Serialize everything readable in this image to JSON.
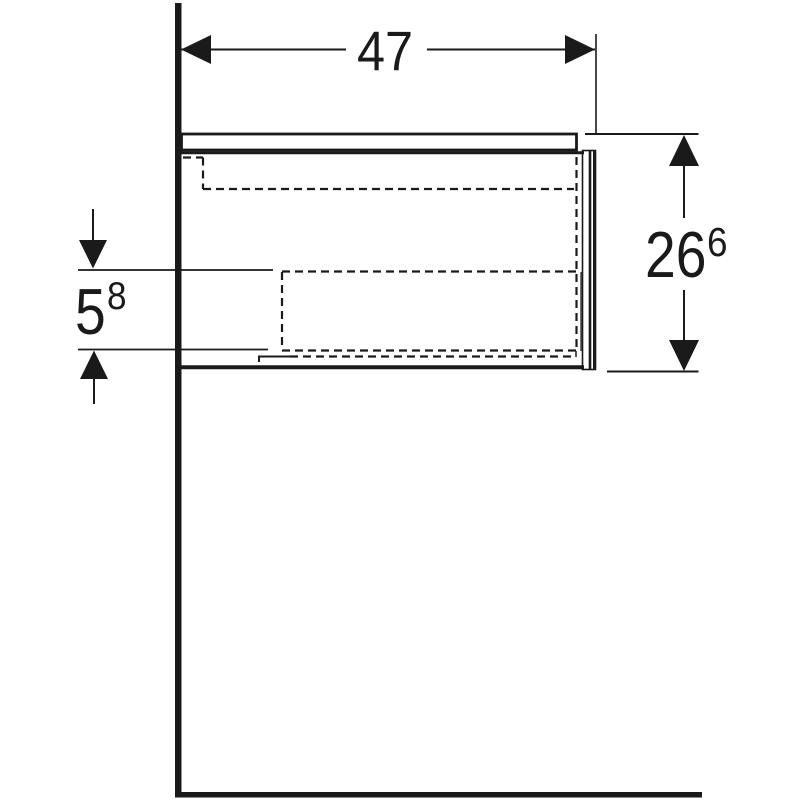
{
  "drawing": {
    "kind": "cabinet-side-elevation-dimension-drawing",
    "colors": {
      "background": "#ffffff",
      "line": "#1a1a1a"
    },
    "dimensions": {
      "width": {
        "value": "47"
      },
      "height": {
        "value": "26",
        "superscript": "6"
      },
      "wall_offset": {
        "value": "5",
        "superscript": "8"
      }
    }
  }
}
